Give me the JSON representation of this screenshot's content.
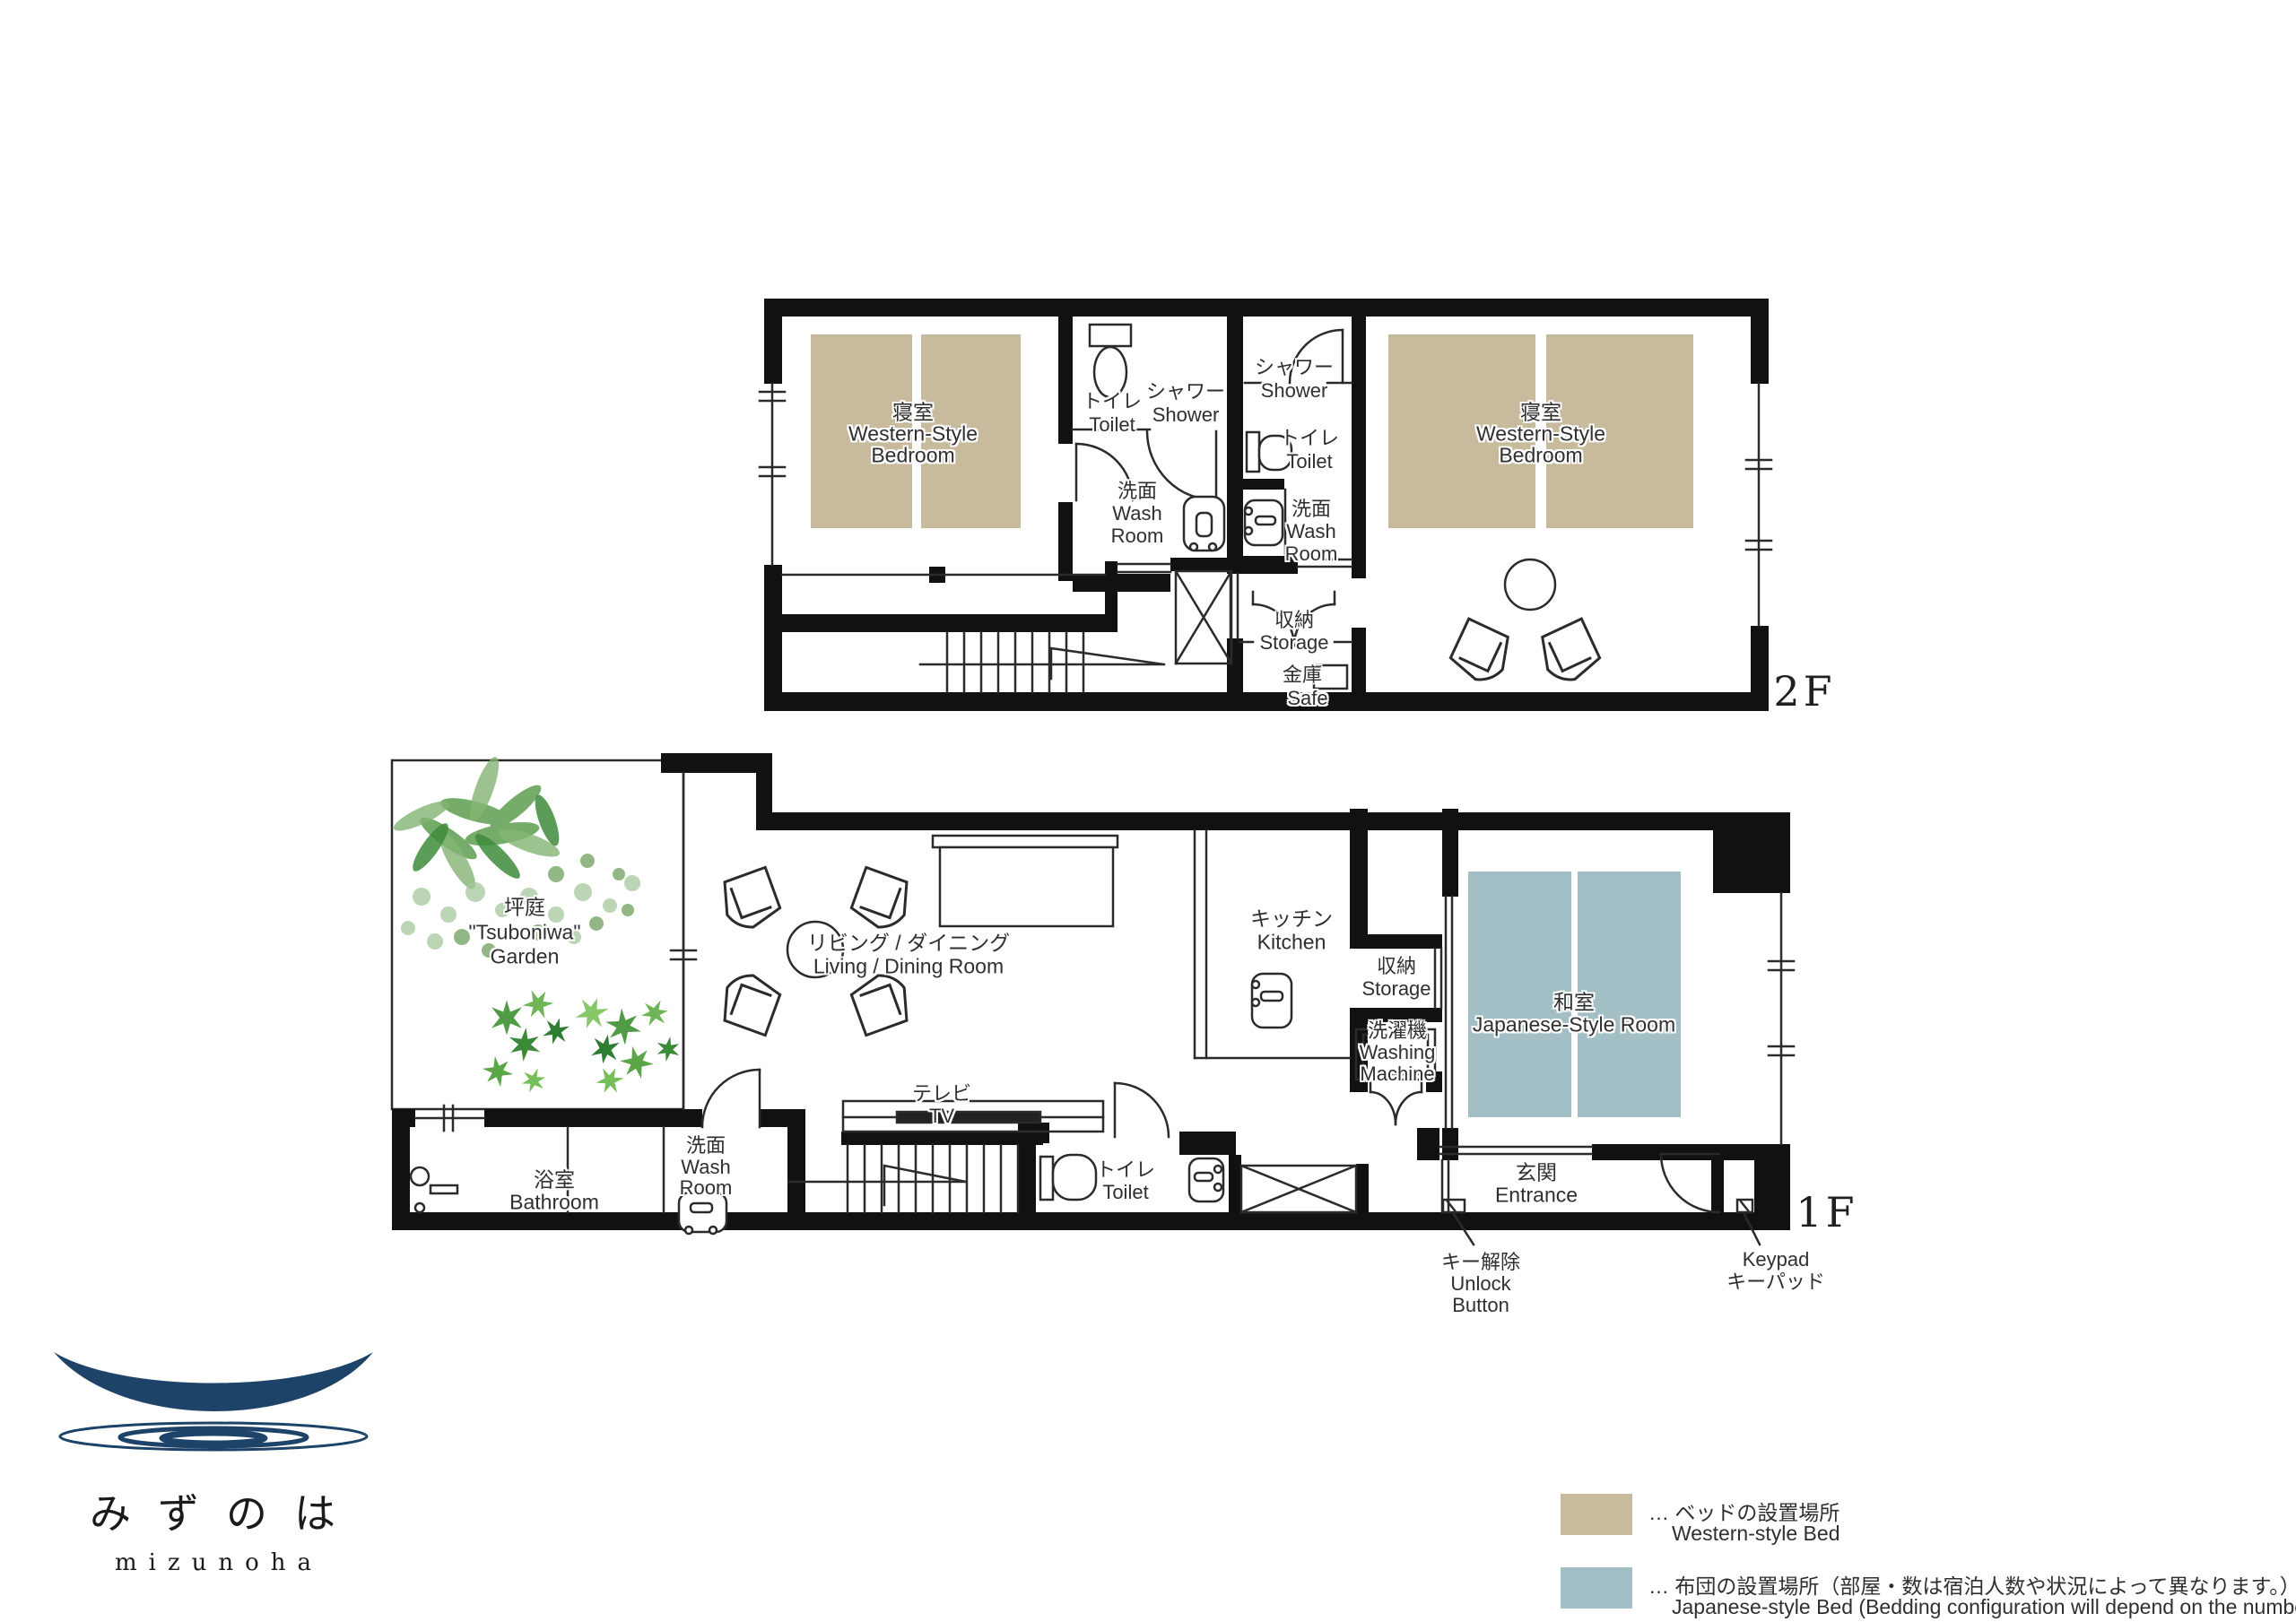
{
  "colors": {
    "bed": "#c8ba9d",
    "futon": "#a2bfc5",
    "wall": "#111111",
    "line": "#2b2b2b",
    "navy": "#1d4468"
  },
  "floor2": {
    "label": "2F",
    "bedroom_left": {
      "jp": "寝室",
      "en1": "Western-Style",
      "en2": "Bedroom"
    },
    "toilet_a": {
      "jp": "トイレ",
      "en": "Toilet"
    },
    "shower_a": {
      "jp": "シャワー",
      "en": "Shower"
    },
    "washroom_a": {
      "jp": "洗面",
      "en1": "Wash",
      "en2": "Room"
    },
    "shower_b": {
      "jp": "シャワー",
      "en": "Shower"
    },
    "toilet_b": {
      "jp": "トイレ",
      "en": "Toilet"
    },
    "washroom_b": {
      "jp": "洗面",
      "en1": "Wash",
      "en2": "Room"
    },
    "storage": {
      "jp": "収納",
      "en": "Storage"
    },
    "safe": {
      "jp": "金庫",
      "en": "Safe"
    },
    "bedroom_right": {
      "jp": "寝室",
      "en1": "Western-Style",
      "en2": "Bedroom"
    }
  },
  "floor1": {
    "label": "1F",
    "garden": {
      "jp": "坪庭",
      "en1": "\"Tsuboniwa\"",
      "en2": "Garden"
    },
    "living": {
      "jp": "リビング / ダイニング",
      "en": "Living / Dining Room"
    },
    "kitchen": {
      "jp": "キッチン",
      "en": "Kitchen"
    },
    "storage": {
      "jp": "収納",
      "en": "Storage"
    },
    "washing_machine": {
      "jp": "洗濯機",
      "en1": "Washing",
      "en2": "Machine"
    },
    "japanese_room": {
      "jp": "和室",
      "en": "Japanese-Style Room"
    },
    "entrance": {
      "jp": "玄関",
      "en": "Entrance"
    },
    "bathroom": {
      "jp": "浴室",
      "en": "Bathroom"
    },
    "washroom": {
      "jp": "洗面",
      "en1": "Wash",
      "en2": "Room"
    },
    "tv": {
      "jp": "テレビ",
      "en": "TV"
    },
    "toilet": {
      "jp": "トイレ",
      "en": "Toilet"
    },
    "unlock": {
      "jp": "キー解除",
      "en1": "Unlock",
      "en2": "Button"
    },
    "keypad": {
      "en": "Keypad",
      "jp": "キーパッド"
    }
  },
  "logo": {
    "jp": "みずのは",
    "en": "mizunoha"
  },
  "legend": {
    "items": [
      {
        "jp": "… ベッドの設置場所",
        "en": "Western-style Bed"
      },
      {
        "jp": "… 布団の設置場所（部屋・数は宿泊人数や状況によって異なります。）",
        "en": "Japanese-style Bed  (Bedding configuration will depend on the number of guests)"
      }
    ]
  }
}
